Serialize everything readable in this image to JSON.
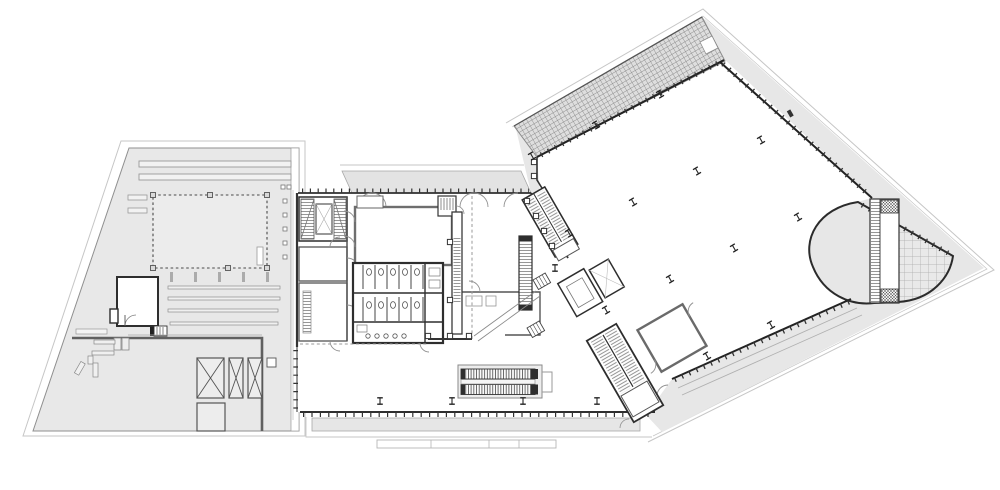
{
  "document": {
    "type": "architectural-floor-plan",
    "title": "Floor plan",
    "description": "Black-and-white architectural floor plan of a three-wing building: a trapezoidal west parking-deck roof, an orthogonal central core block, and a large rotated east hall with trellis roof band, perimeter walkway and curved terrace at its pointed tip",
    "background": "#ffffff"
  },
  "palette": {
    "surface_gray": "#e8e8e8",
    "band_gray": "#e3e3e3",
    "canopy_gray": "#e6e6e6",
    "trellis_bg": "#dedede",
    "pavers_bg": "#e9e9e9",
    "wall_dark": "#2e2e2e",
    "wall_black": "#1f1f1f",
    "wall_medium": "#666666",
    "wall_light": "#8f8f8f",
    "outline_light": "#c6c6c6",
    "hatch_line": "#8d8d8d",
    "dashed_line": "#999999"
  },
  "zones": {
    "west_wing": {
      "label": "West wing roof / parking deck",
      "features": [
        "dashed courtyard opening with column markers",
        "three cross-braced skylight boxes",
        "plain skylight box",
        "plant room",
        "four vent bars",
        "two long roof strips",
        "heavy deck edge line"
      ]
    },
    "central_block": {
      "label": "Central core block",
      "features": [
        "scissor stairwell with elevator",
        "toilet core with stall rows and sinks",
        "service shafts with rungs",
        "large hall",
        "twin escalators with side bracket",
        "glazed south curtain wall",
        "entrance canopy with steps",
        "dashed floor-opening lines"
      ]
    },
    "east_wing": {
      "label": "East hall (rotated wing)",
      "features": [
        "gridded trellis roof band",
        "mullioned glass walls",
        "perimeter walkway band",
        "curved terrace wall",
        "paver-grid terrace at tip",
        "straight stair strip",
        "switchback stair",
        "elevator pair",
        "column grid"
      ]
    }
  },
  "counts": {
    "columns_east": 13,
    "columns_central": 5,
    "toilet_stalls": 10,
    "sinks": 5,
    "urinals": 5,
    "escalator_runs": 2,
    "skylight_boxes": 3,
    "stairs_total": 5,
    "elevators_total": 3
  }
}
